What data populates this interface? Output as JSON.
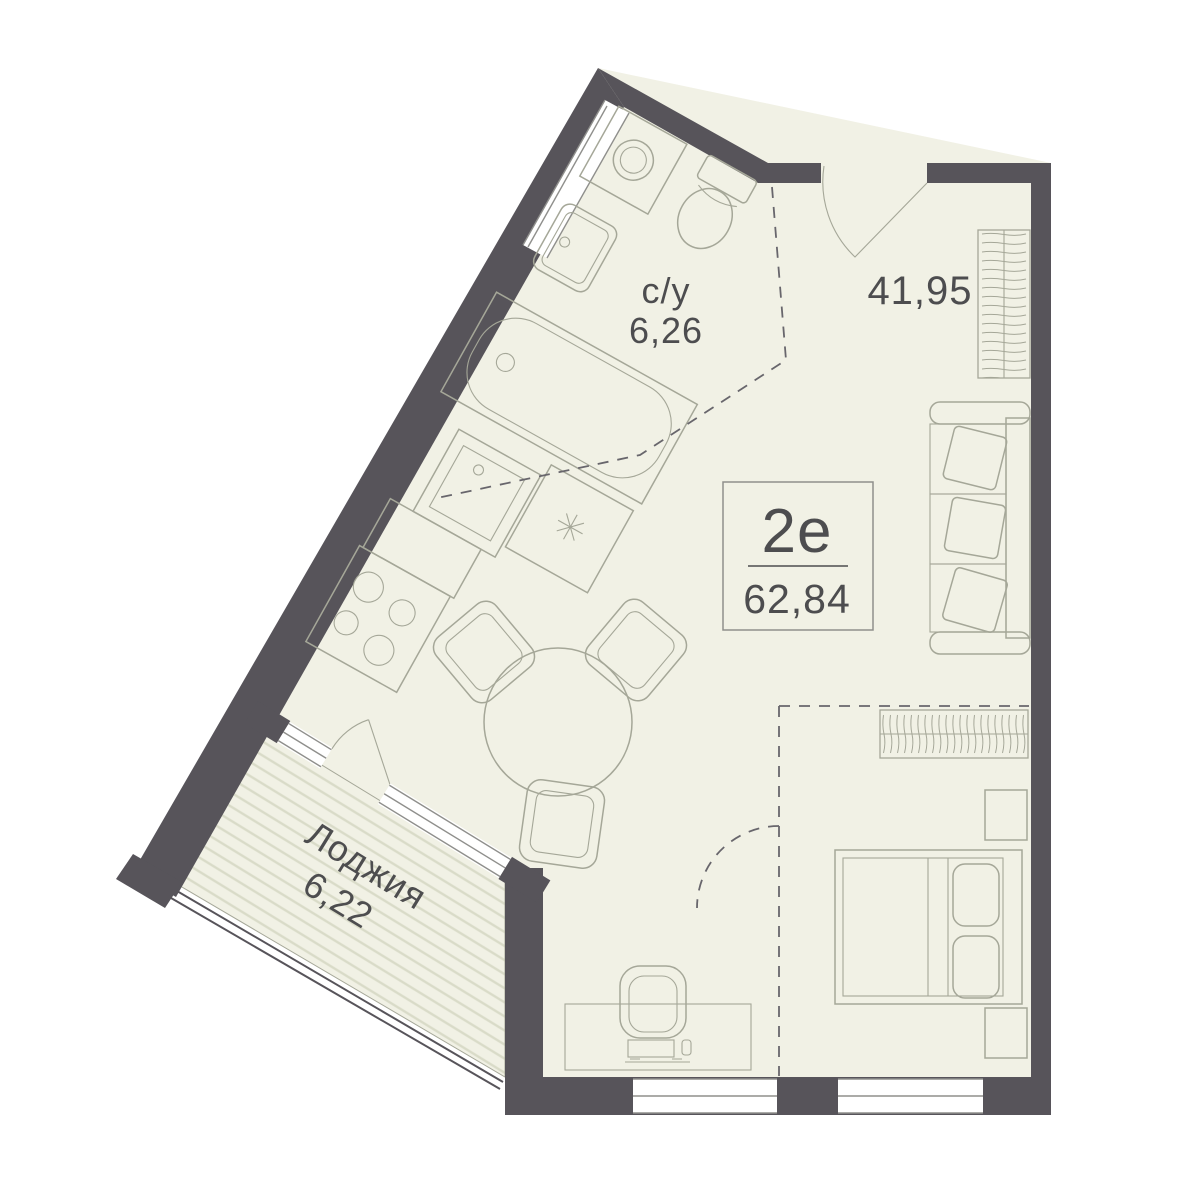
{
  "plan": {
    "unit": {
      "type": "2е",
      "area": "62,84"
    },
    "main_room": {
      "area": "41,95"
    },
    "bathroom": {
      "name": "с/у",
      "area": "6,26"
    },
    "loggia": {
      "name": "Лоджия",
      "area": "6,22"
    },
    "furniture_symbols": [
      "washing-machine",
      "toilet",
      "wash-basin",
      "bathtub",
      "kitchen-sink",
      "fridge",
      "stove",
      "dining-table",
      "chair",
      "sofa",
      "wardrobe",
      "bed",
      "nightstand",
      "desk",
      "desk-chair"
    ],
    "colors": {
      "wall": "#57545a",
      "floor": "#f1f1e5",
      "hatch": "#d9dbc8",
      "furniture": "#a5a798",
      "dash": "#68666c",
      "text": "#4d4d4f",
      "frame": "#8f8f8c",
      "window": "#ffffff"
    }
  }
}
